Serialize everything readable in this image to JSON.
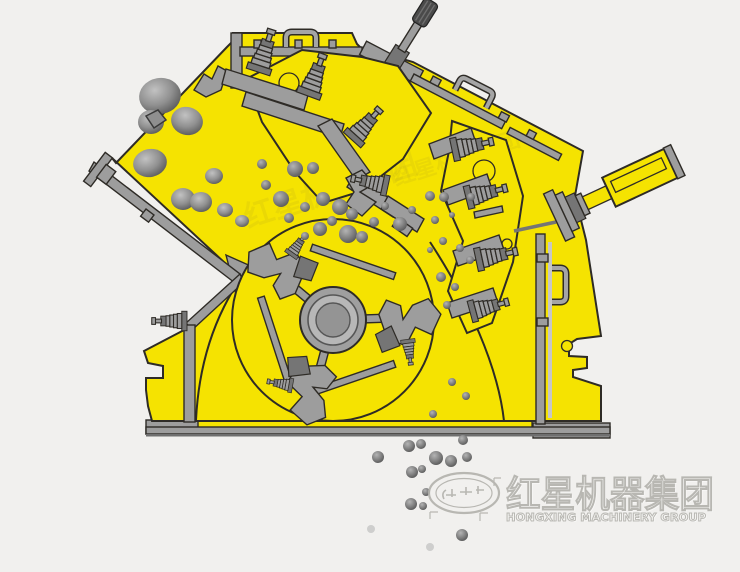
{
  "watermark": {
    "logo": "star-oval-emblem",
    "cn": "红星机器集团",
    "en": "HONGXING MACHINERY GROUP"
  },
  "colors": {
    "background": "#f1f0ee",
    "body_yellow": "#f5e301",
    "outline": "#2e2b26",
    "metal": "#9d9d9d",
    "metal_dark": "#757575",
    "metal_light": "#c6c6c6",
    "rock_dark": "#5f5f5f",
    "knurl": "#4a4a4a",
    "watermark": "#b2b1ac"
  }
}
